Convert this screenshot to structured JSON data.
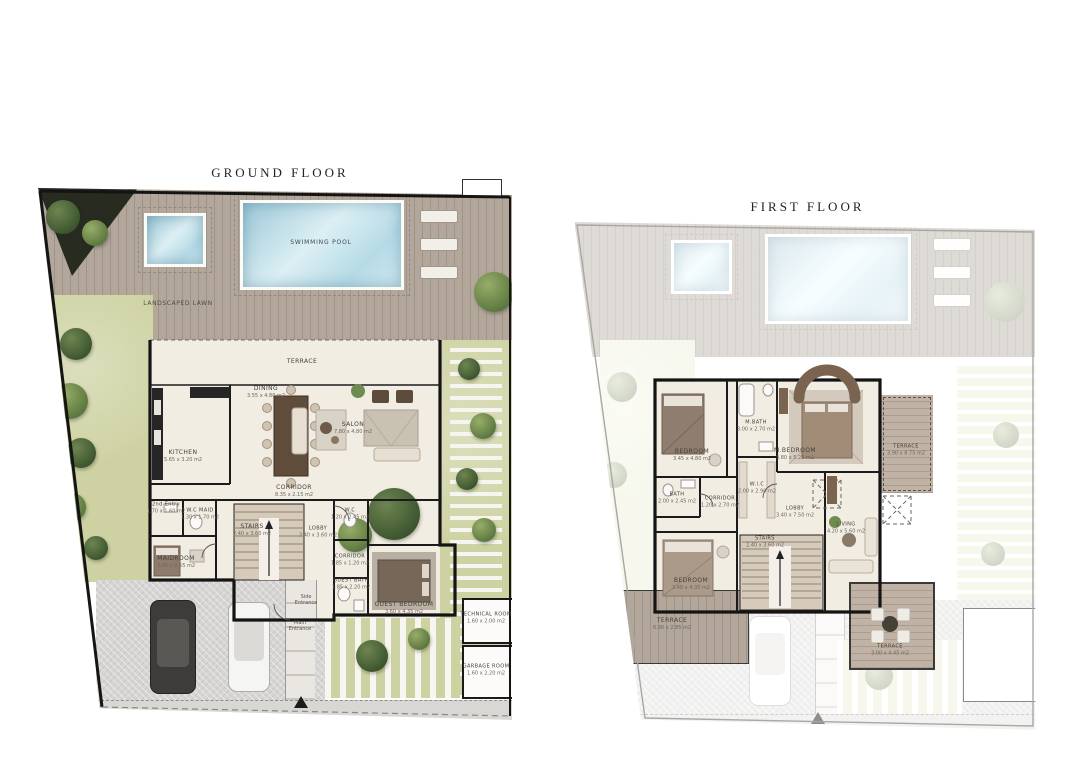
{
  "sheet": {
    "background": "#ffffff"
  },
  "ground_floor": {
    "title": "GROUND FLOOR",
    "outdoor": {
      "swimming_pool_label": "SWIMMING POOL",
      "landscaped_lawn_label": "LANDSCAPED LAWN",
      "main_entrance_label": "Main Entrance",
      "side_entrance_label": "Side Entrance"
    },
    "rooms": [
      {
        "name": "TERRACE",
        "dims": ""
      },
      {
        "name": "DINING",
        "dims": "3.55 x 4.80 m2"
      },
      {
        "name": "SALON",
        "dims": "7.80 x 4.80 m2"
      },
      {
        "name": "KITCHEN",
        "dims": "5.65 x 3.20 m2"
      },
      {
        "name": "CORRIDOR",
        "dims": "8.35 x 2.15 m2"
      },
      {
        "name": "2nd Entry",
        "dims": "1.70 x 1.60 m2"
      },
      {
        "name": "W.C MAID",
        "dims": "1.30 x 1.70 m2"
      },
      {
        "name": "MAIDROOM",
        "dims": "3.45 x 2.55 m2"
      },
      {
        "name": "STAIRS",
        "dims": "2.40 x 3.60 m2"
      },
      {
        "name": "LOBBY",
        "dims": "2.40 x 3.60 m2"
      },
      {
        "name": "W.C",
        "dims": "1.20 x 2.45 m2"
      },
      {
        "name": "CORRIDOR",
        "dims": "1.85 x 1.20 m2"
      },
      {
        "name": "GUEST BATH",
        "dims": "1.85 x 2.20 m2"
      },
      {
        "name": "GUEST BEDROOM",
        "dims": "3.60 x 4.35 m2"
      },
      {
        "name": "TECHNICAL ROOM",
        "dims": "1.60 x 2.00 m2"
      },
      {
        "name": "GARBAGE ROOM",
        "dims": "1.60 x 2.20 m2"
      }
    ]
  },
  "first_floor": {
    "title": "FIRST FLOOR",
    "rooms": [
      {
        "name": "BEDROOM",
        "dims": "3.45 x 4.80 m2"
      },
      {
        "name": "M.BATH",
        "dims": "3.00 x 2.70 m2"
      },
      {
        "name": "W.I.C",
        "dims": "2.00 x 2.90 m2"
      },
      {
        "name": "M.BEDROOM",
        "dims": "3.80 x 5.20 m2"
      },
      {
        "name": "TERRACE",
        "dims": "3.90 x 8.75 m2"
      },
      {
        "name": "BATH",
        "dims": "2.00 x 2.45 m2"
      },
      {
        "name": "CORRIDOR",
        "dims": "1.20 x 2.70 m2"
      },
      {
        "name": "LOBBY",
        "dims": "3.40 x 7.50 m2"
      },
      {
        "name": "STAIRS",
        "dims": "2.40 x 3.60 m2"
      },
      {
        "name": "LIVING",
        "dims": "4.20 x 5.60 m2"
      },
      {
        "name": "BEDROOM",
        "dims": "3.40 x 4.35 m2"
      },
      {
        "name": "TERRACE",
        "dims": "6.90 x 2.85 m2"
      },
      {
        "name": "TERRACE",
        "dims": "3.00 x 4.45 m2"
      }
    ]
  },
  "palette": {
    "deck_wood": "#b3a79b",
    "pool_water": "#aed3e0",
    "lawn_green": "#ced2a2",
    "interior_floor": "#f2ede3",
    "wall_black": "#141414",
    "paving_grey": "#d7d5d3",
    "tree_green": "#5e7a41"
  }
}
